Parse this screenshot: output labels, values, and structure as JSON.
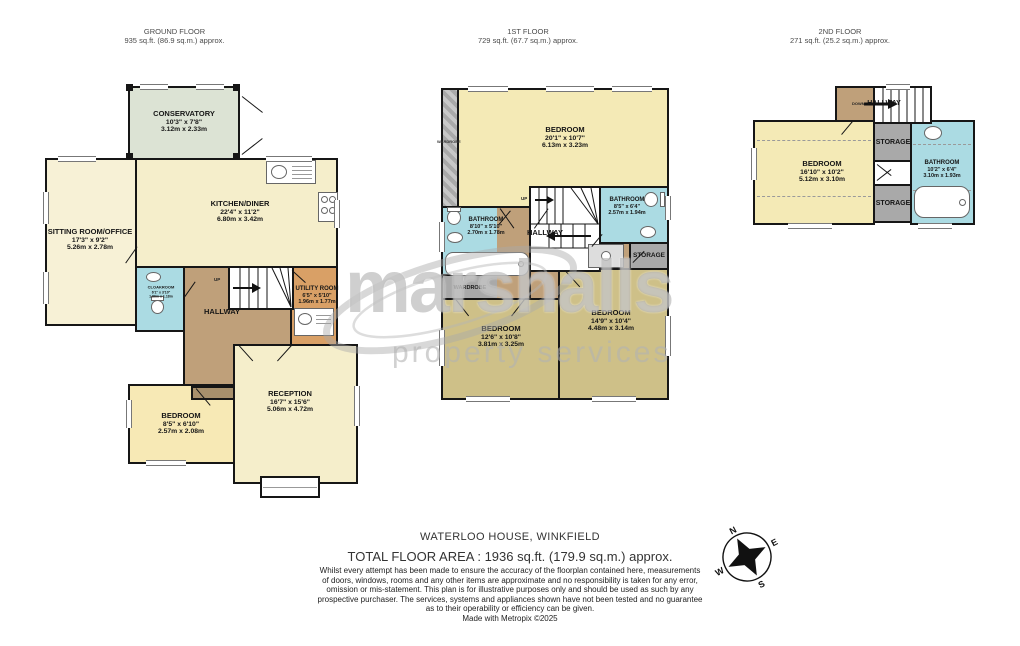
{
  "watermark": {
    "brand": "marshalls",
    "tagline": "property services"
  },
  "floors": {
    "ground": {
      "title": "GROUND FLOOR",
      "area": "935 sq.ft. (86.9 sq.m.) approx.",
      "rooms": {
        "conservatory": {
          "name": "CONSERVATORY",
          "imperial": "10'3\" x 7'8\"",
          "metric": "3.12m x 2.33m"
        },
        "sitting_room": {
          "name": "SITTING ROOM/OFFICE",
          "imperial": "17'3\" x 9'2\"",
          "metric": "5.26m x 2.78m"
        },
        "kitchen_diner": {
          "name": "KITCHEN/DINER",
          "imperial": "22'4\" x 11'2\"",
          "metric": "6.80m x 3.42m"
        },
        "cloakroom": {
          "name": "CLOAKROOM",
          "imperial": "6'1\" x 3'10\"",
          "metric": "1.86m x 1.18m"
        },
        "hallway": {
          "name": "HALLWAY"
        },
        "utility_room": {
          "name": "UTILITY ROOM",
          "imperial": "6'5\" x 5'10\"",
          "metric": "1.96m x 1.77m"
        },
        "bedroom": {
          "name": "BEDROOM",
          "imperial": "8'5\" x 6'10\"",
          "metric": "2.57m x 2.08m"
        },
        "reception": {
          "name": "RECEPTION",
          "imperial": "16'7\" x 15'6\"",
          "metric": "5.06m x 4.72m"
        },
        "up_label": "UP"
      }
    },
    "first": {
      "title": "1ST FLOOR",
      "area": "729 sq.ft. (67.7 sq.m.) approx.",
      "rooms": {
        "bedroom_main": {
          "name": "BEDROOM",
          "imperial": "20'1\" x 10'7\"",
          "metric": "6.13m x 3.23m"
        },
        "wardrobe_side": {
          "name": "WARDROBE"
        },
        "bathroom_left": {
          "name": "BATHROOM",
          "imperial": "8'10\" x 5'10\"",
          "metric": "2.70m x 1.78m"
        },
        "bathroom_right": {
          "name": "BATHROOM",
          "imperial": "8'5\" x 6'4\"",
          "metric": "2.57m x 1.94m"
        },
        "hallway": {
          "name": "HALLWAY"
        },
        "wardrobe_bottom": {
          "name": "WARDROBE"
        },
        "storage": {
          "name": "STORAGE"
        },
        "bedroom_left": {
          "name": "BEDROOM",
          "imperial": "12'6\" x 10'8\"",
          "metric": "3.81m x 3.25m"
        },
        "bedroom_right": {
          "name": "BEDROOM",
          "imperial": "14'9\" x 10'4\"",
          "metric": "4.48m x 3.14m"
        },
        "up_label": "UP"
      }
    },
    "second": {
      "title": "2ND FLOOR",
      "area": "271 sq.ft. (25.2 sq.m.) approx.",
      "rooms": {
        "hallway": {
          "name": "HALLWAY"
        },
        "down_label": "DOWN",
        "bedroom": {
          "name": "BEDROOM",
          "imperial": "16'10\" x 10'2\"",
          "metric": "5.12m x 3.10m"
        },
        "storage_top": {
          "name": "STORAGE"
        },
        "storage_bottom": {
          "name": "STORAGE"
        },
        "bathroom": {
          "name": "BATHROOM",
          "imperial": "10'2\" x 6'4\"",
          "metric": "3.10m x 1.93m"
        }
      }
    }
  },
  "compass": {
    "north": "N",
    "east": "E",
    "south": "S",
    "west": "W"
  },
  "footer": {
    "property_name": "WATERLOO HOUSE, WINKFIELD",
    "total_area": "TOTAL FLOOR AREA : 1936 sq.ft. (179.9 sq.m.) approx.",
    "disclaimer_lines": [
      "Whilst every attempt has been made to ensure the accuracy of the floorplan contained here, measurements",
      "of doors, windows, rooms and any other items are approximate and no responsibility is taken for any error,",
      "omission or mis-statement. This plan is for illustrative purposes only and should be used as such by any",
      "prospective purchaser. The services, systems and appliances shown have not been tested and no guarantee",
      "as to their operability or efficiency can be given."
    ],
    "made_with": "Made with Metropix ©2025"
  },
  "colors": {
    "wall": "#161616",
    "cream": "#f5eecb",
    "pale_yellow": "#f4eab6",
    "sitting": "#f7f1d6",
    "bedroom_ground": "#f7e9b5",
    "conservatory": "#dce3d4",
    "hall_tan": "#bfa07a",
    "utility_orange": "#d9a066",
    "bath_blue": "#abdbe3",
    "khaki": "#cec088",
    "storage_gray": "#a9a9a9"
  }
}
